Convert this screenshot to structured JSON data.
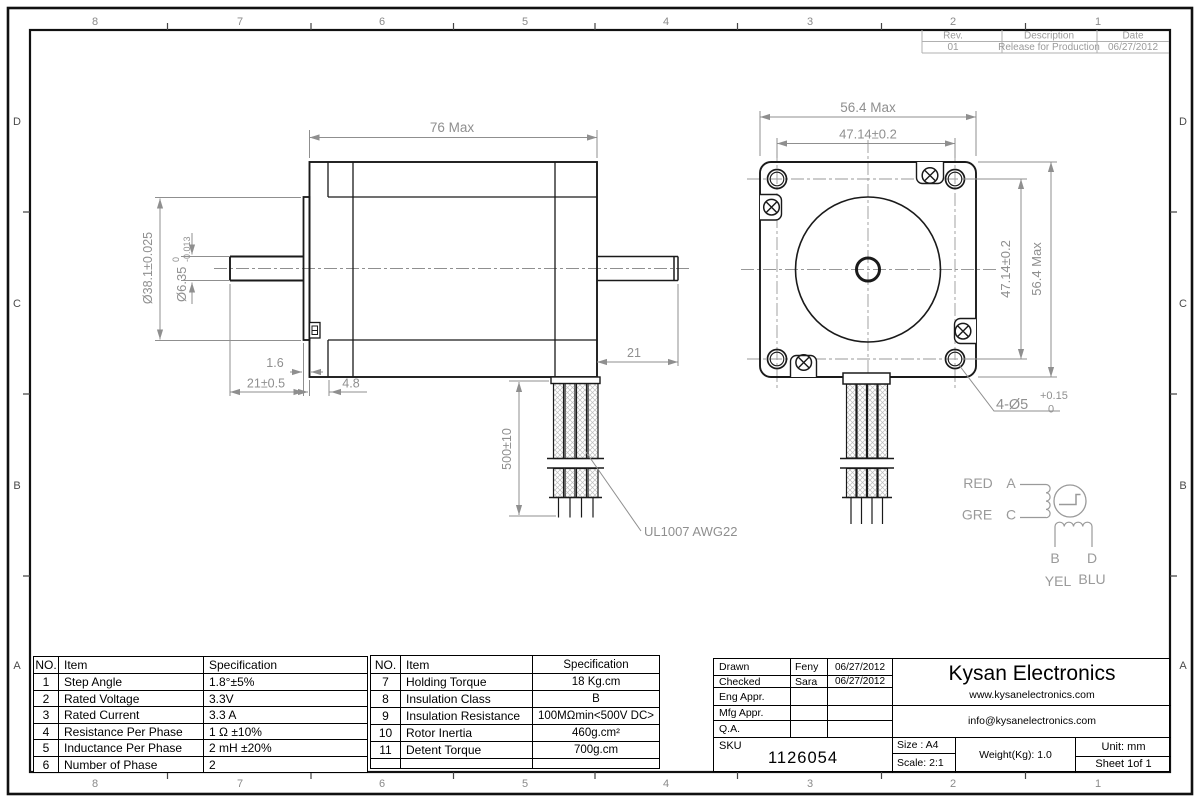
{
  "sheet": {
    "zones": {
      "columns": [
        "8",
        "7",
        "6",
        "5",
        "4",
        "3",
        "2",
        "1"
      ],
      "rows": [
        "D",
        "C",
        "B",
        "A"
      ]
    },
    "revision_table": {
      "headers": [
        "Rev.",
        "Description",
        "Date"
      ],
      "row": {
        "rev": "01",
        "description": "Release for Production",
        "date": "06/27/2012"
      }
    }
  },
  "side_view": {
    "dim_overall": "76 Max",
    "dim_boss_dia": "Ø38.1±0.025",
    "dim_shaft_dia": "Ø6.35",
    "shaft_tol_upper": "0",
    "shaft_tol_lower": "-0.013",
    "dim_boss_thickness": "1.6",
    "dim_shaft_length": "21±0.5",
    "dim_front_cap": "4.8",
    "dim_rear_shaft": "21",
    "dim_lead_length": "500±10",
    "lead_label": "UL1007  AWG22"
  },
  "front_view": {
    "dim_width": "56.4 Max",
    "dim_hole_spacing_h": "47.14±0.2",
    "dim_hole_spacing_v": "47.14±0.2",
    "dim_height": "56.4 Max",
    "dim_holes": "4-Ø5",
    "holes_tol_upper": "+0.15",
    "holes_tol_lower": "0"
  },
  "wiring_diagram": {
    "lead_red": "RED",
    "lead_gre": "GRE",
    "lead_yel": "YEL",
    "lead_blu": "BLU",
    "term_a": "A",
    "term_b": "B",
    "term_c": "C",
    "term_d": "D"
  },
  "spec_table_left": {
    "headers": [
      "NO.",
      "Item",
      "Specification"
    ],
    "rows": [
      [
        "1",
        "Step Angle",
        "1.8°±5%"
      ],
      [
        "2",
        "Rated Voltage",
        "3.3V"
      ],
      [
        "3",
        "Rated Current",
        "3.3 A"
      ],
      [
        "4",
        "Resistance Per Phase",
        "1 Ω ±10%"
      ],
      [
        "5",
        "Inductance Per Phase",
        "2 mH ±20%"
      ],
      [
        "6",
        "Number of Phase",
        "2"
      ]
    ]
  },
  "spec_table_right": {
    "headers": [
      "NO.",
      "Item",
      "Specification"
    ],
    "rows": [
      [
        "7",
        "Holding Torque",
        "18 Kg.cm"
      ],
      [
        "8",
        "Insulation Class",
        "B"
      ],
      [
        "9",
        "Insulation Resistance",
        "100MΩmin<500V DC>"
      ],
      [
        "10",
        "Rotor Inertia",
        "460g.cm²"
      ],
      [
        "11",
        "Detent Torque",
        "700g.cm"
      ]
    ]
  },
  "title_block": {
    "approvals": [
      {
        "label": "Drawn",
        "name": "Feny",
        "date": "06/27/2012"
      },
      {
        "label": "Checked",
        "name": "Sara",
        "date": "06/27/2012"
      },
      {
        "label": "Eng Appr.",
        "name": "",
        "date": ""
      },
      {
        "label": "Mfg Appr.",
        "name": "",
        "date": ""
      },
      {
        "label": "Q.A.",
        "name": "",
        "date": ""
      }
    ],
    "sku_label": "SKU",
    "sku_number": "1126054",
    "company": "Kysan Electronics",
    "website": "www.kysanelectronics.com",
    "email": "info@kysanelectronics.com",
    "size": "Size : A4",
    "scale": "Scale: 2:1",
    "weight": "Weight(Kg):  1.0",
    "unit": "Unit: mm",
    "sheet": "Sheet 1of 1"
  }
}
